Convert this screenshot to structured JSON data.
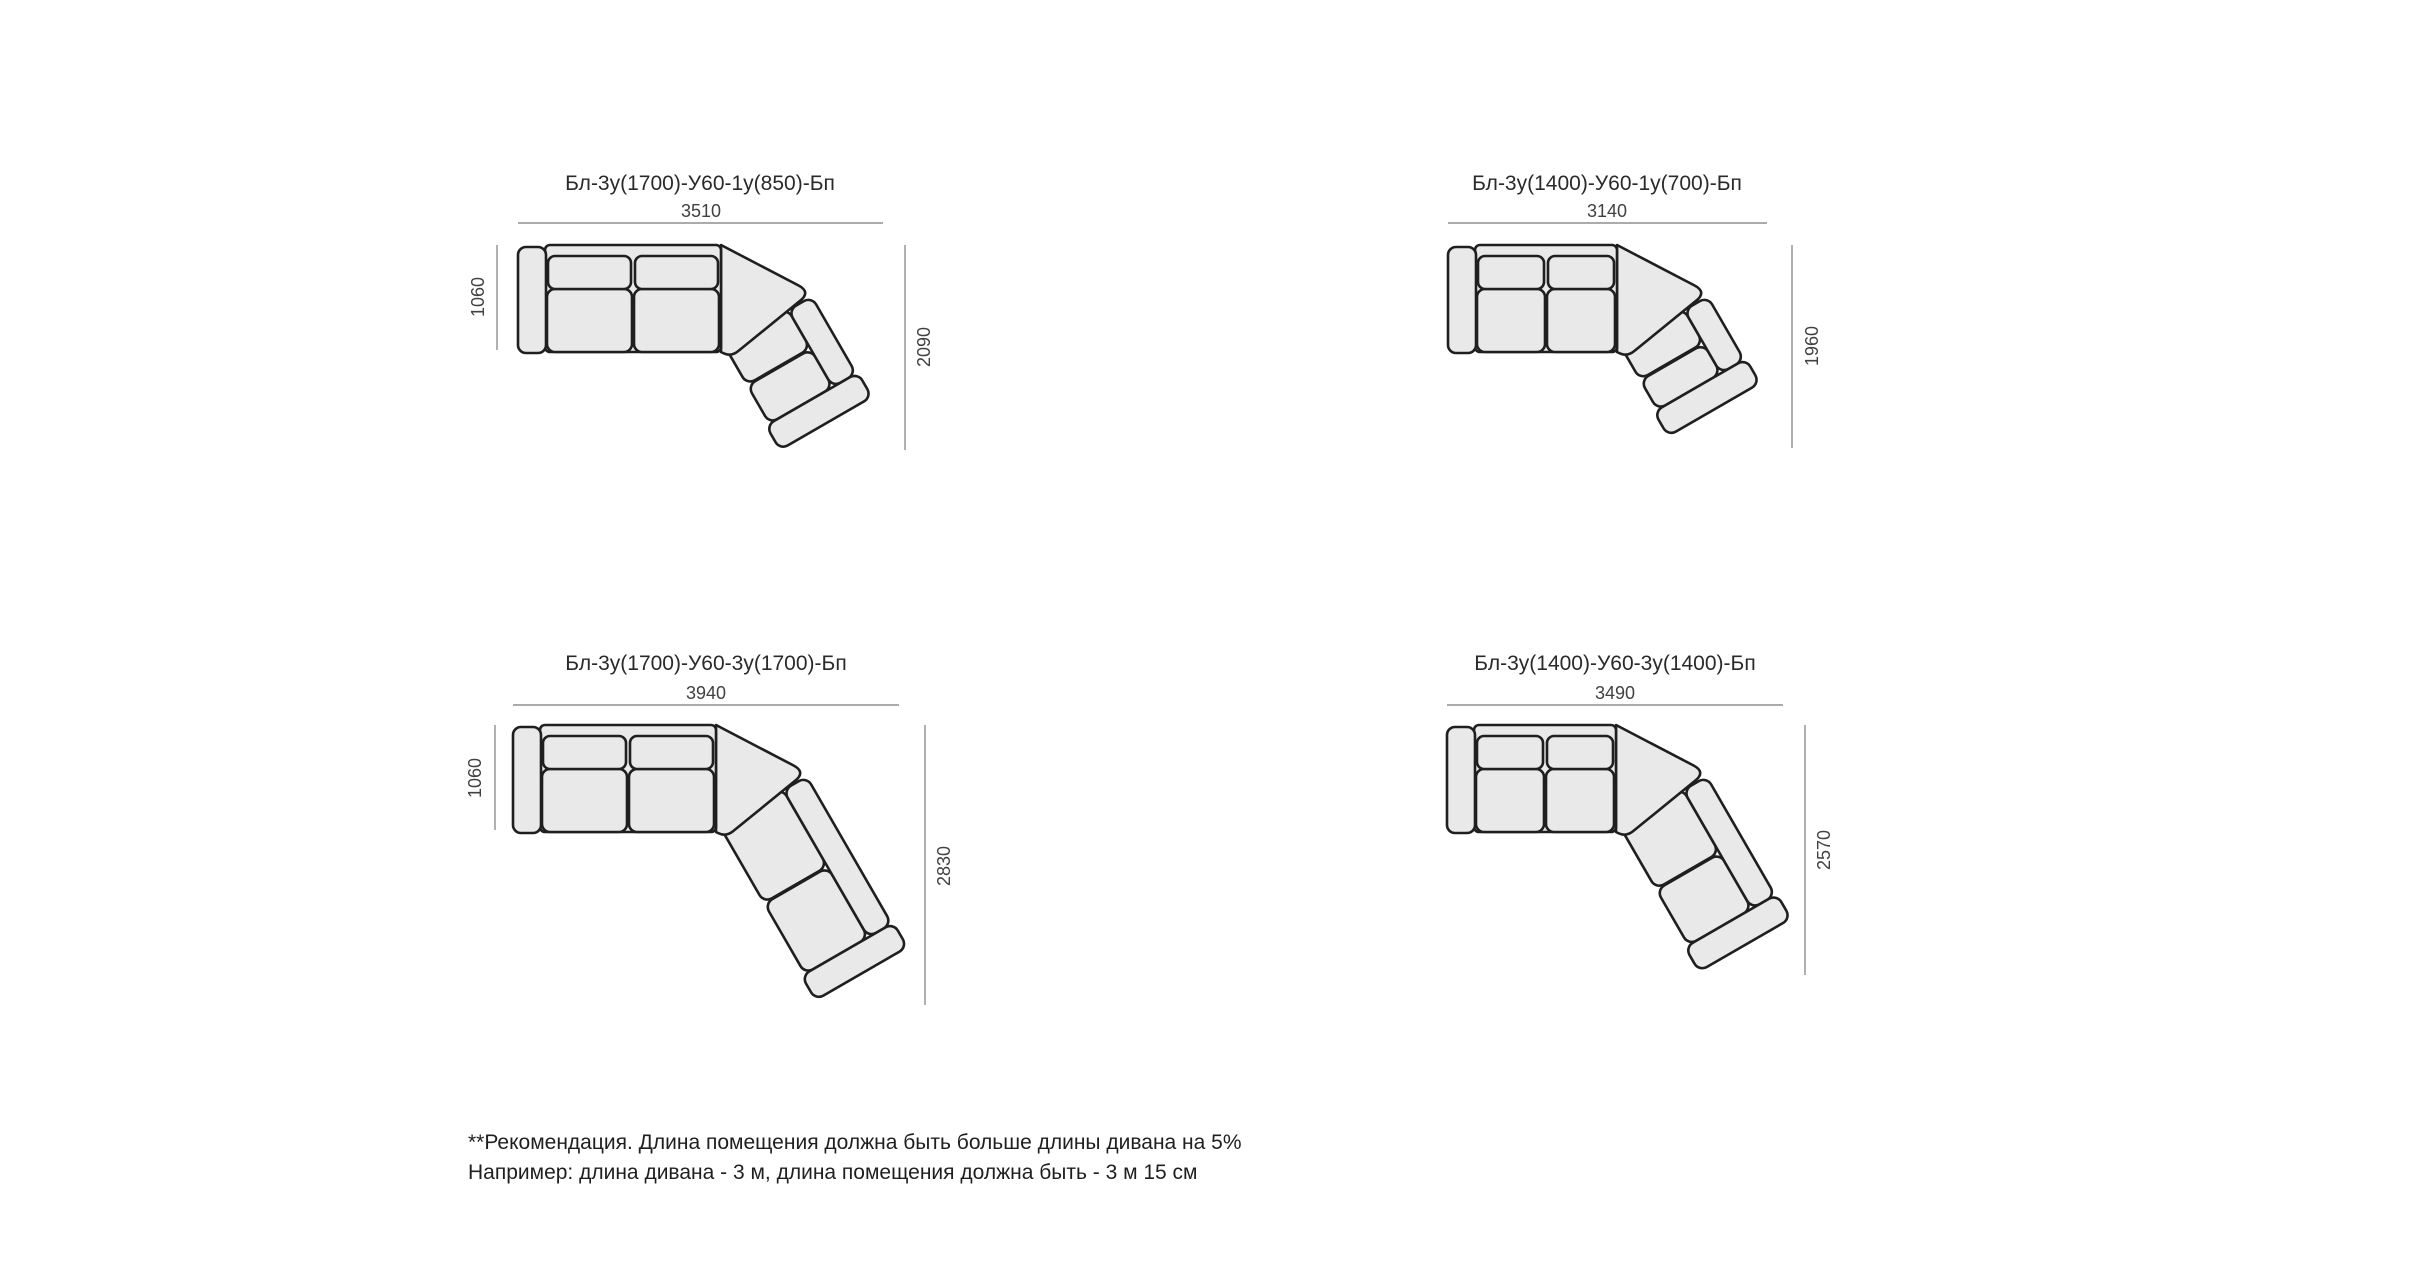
{
  "page": {
    "background": "#ffffff"
  },
  "colors": {
    "sofa_fill": "#e9e9e9",
    "sofa_stroke": "#1f1f1f",
    "dim_line": "#8f8f8f",
    "dim_text": "#414141",
    "title_text": "#2a2a2a"
  },
  "diagrams": [
    {
      "id": "top-left",
      "title": "Бл-3у(1700)-У60-1у(850)-Бп",
      "dims": {
        "top": "3510",
        "left": "1060",
        "right": "2090"
      }
    },
    {
      "id": "top-right",
      "title": "Бл-3у(1400)-У60-1у(700)-Бп",
      "dims": {
        "top": "3140",
        "right": "1960"
      }
    },
    {
      "id": "bottom-left",
      "title": "Бл-3у(1700)-У60-3у(1700)-Бп",
      "dims": {
        "top": "3940",
        "left": "1060",
        "right": "2830"
      }
    },
    {
      "id": "bottom-right",
      "title": "Бл-3у(1400)-У60-3у(1400)-Бп",
      "dims": {
        "top": "3490",
        "right": "2570"
      }
    }
  ],
  "footnote": {
    "line1": "**Рекомендация. Длина помещения должна быть больше длины дивана на 5%",
    "line2": "Например: длина дивана - 3 м, длина помещения должна быть - 3 м 15 см"
  }
}
